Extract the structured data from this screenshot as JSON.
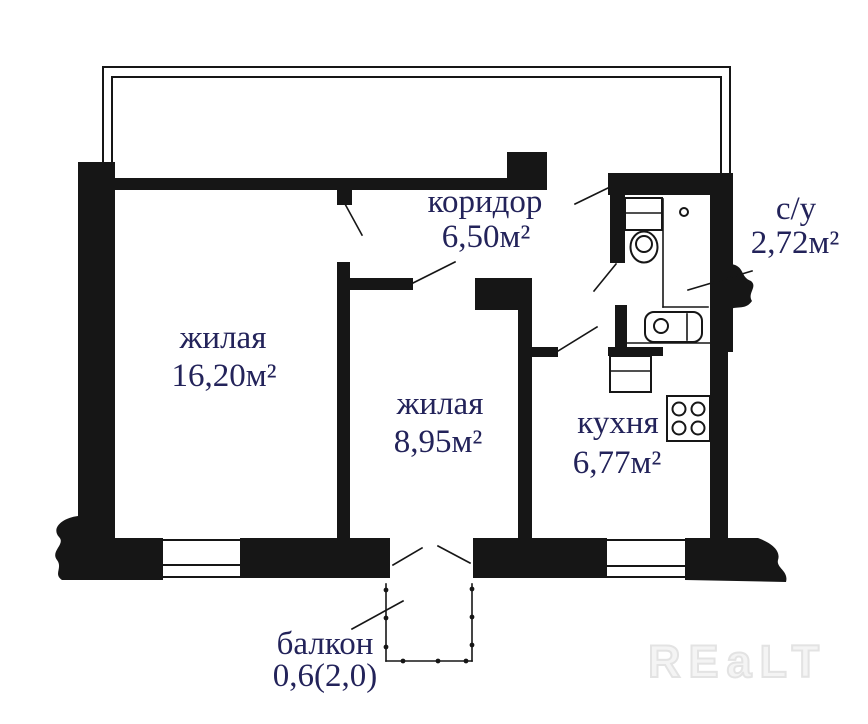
{
  "plan": {
    "rooms": [
      {
        "name": "жилая",
        "area": "16,20м²"
      },
      {
        "name": "жилая",
        "area": "8,95м²"
      },
      {
        "name": "кухня",
        "area": "6,77м²"
      },
      {
        "name": "коридор",
        "area": "6,50м²"
      },
      {
        "name": "с/у",
        "area": "2,72м²"
      },
      {
        "name": "балкон",
        "area": "0,6(2,0)"
      }
    ],
    "watermark": "REaLT",
    "colors": {
      "wall": "#161616",
      "label": "#23235a",
      "watermark": "#e3e3e3"
    }
  }
}
